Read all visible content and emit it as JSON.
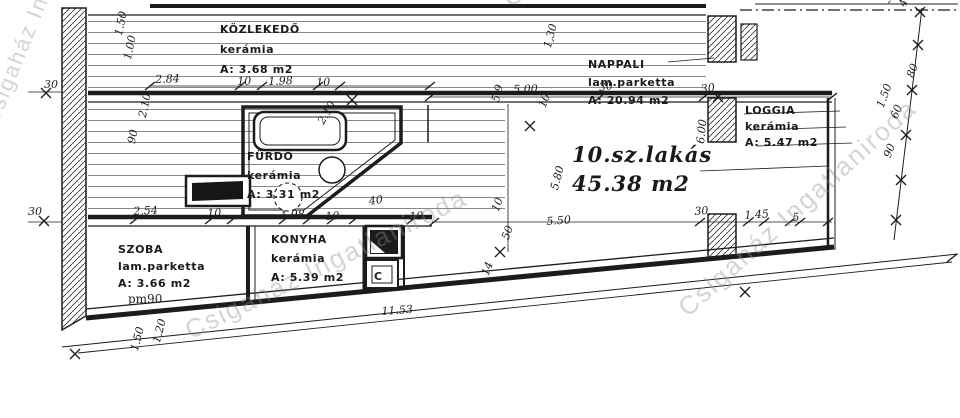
{
  "title": "10.sz.lakás floor plan",
  "colors": {
    "ink": "#1c1c1c",
    "paper": "#ffffff",
    "watermark_gray": "#8f8f8f"
  },
  "apartment": {
    "line1": "10.sz.lakás",
    "line2": "45.38 m2"
  },
  "watermark": {
    "text": "Csigaház Ingatlaniroda",
    "items": [
      {
        "x": 496,
        "y": -10,
        "r": -40,
        "s": 26
      },
      {
        "x": 180,
        "y": 318,
        "r": -26,
        "s": 26
      },
      {
        "x": 672,
        "y": 300,
        "r": -42,
        "s": 26
      },
      {
        "x": -22,
        "y": 120,
        "r": -68,
        "s": 22
      }
    ]
  },
  "rooms": [
    {
      "id": "kozlekedo",
      "x": 220,
      "y": 20,
      "lh": 20,
      "lines": [
        "KÖZLEKEDŐ",
        "kerámia",
        "A: 3.68 m2"
      ]
    },
    {
      "id": "nappali",
      "x": 588,
      "y": 56,
      "lh": 18,
      "lines": [
        "NAPPALI",
        "lam.parketta",
        "A: 20.94 m2"
      ]
    },
    {
      "id": "loggia",
      "x": 745,
      "y": 103,
      "lh": 16,
      "lines": [
        "LOGGIA",
        "kerámia",
        "A: 5.47 m2"
      ]
    },
    {
      "id": "furdo",
      "x": 247,
      "y": 147,
      "lh": 19,
      "lines": [
        "FÜRDŐ",
        "kerámia",
        "A: 3.31 m2"
      ]
    },
    {
      "id": "szoba",
      "x": 118,
      "y": 241,
      "lh": 17,
      "lines": [
        "SZOBA",
        "lam.parketta",
        "A: 3.66 m2"
      ]
    },
    {
      "id": "konyha",
      "x": 271,
      "y": 230,
      "lh": 19,
      "lines": [
        "KONYHA",
        "kerámia",
        "A: 5.39 m2"
      ]
    }
  ],
  "labels": [
    {
      "t": "pm90",
      "x": 128,
      "y": 292,
      "name": "parapet-height-label"
    },
    {
      "t": "C",
      "x": 374,
      "y": 270,
      "cls": "c-label",
      "name": "convector-label"
    }
  ],
  "dimensions": [
    {
      "t": "30",
      "x": 44,
      "y": 78,
      "r": 0
    },
    {
      "t": "30",
      "x": 28,
      "y": 205,
      "r": 0
    },
    {
      "t": "1.50",
      "x": 112,
      "y": 34,
      "r": -78
    },
    {
      "t": "1.00",
      "x": 121,
      "y": 58,
      "r": -78
    },
    {
      "t": "2.84",
      "x": 155,
      "y": 73,
      "r": -2
    },
    {
      "t": "10",
      "x": 237,
      "y": 75,
      "r": -2
    },
    {
      "t": "1.98",
      "x": 268,
      "y": 75,
      "r": -2
    },
    {
      "t": "10",
      "x": 316,
      "y": 76,
      "r": -2
    },
    {
      "t": "5,00",
      "x": 513,
      "y": 83,
      "r": -2
    },
    {
      "t": "1,30",
      "x": 541,
      "y": 46,
      "r": -75
    },
    {
      "t": "5.9",
      "x": 489,
      "y": 100,
      "r": -75
    },
    {
      "t": "10",
      "x": 536,
      "y": 105,
      "r": -70
    },
    {
      "t": "30",
      "x": 598,
      "y": 81,
      "r": -8
    },
    {
      "t": "30",
      "x": 700,
      "y": 83,
      "r": -8
    },
    {
      "t": "2.10",
      "x": 136,
      "y": 116,
      "r": -78
    },
    {
      "t": "90",
      "x": 125,
      "y": 142,
      "r": -78
    },
    {
      "t": "2.10",
      "x": 315,
      "y": 120,
      "r": -60
    },
    {
      "t": "6.00",
      "x": 694,
      "y": 143,
      "r": -84
    },
    {
      "t": "2.54",
      "x": 133,
      "y": 205,
      "r": -3
    },
    {
      "t": "10",
      "x": 207,
      "y": 207,
      "r": -3
    },
    {
      "t": "1.98",
      "x": 280,
      "y": 209,
      "r": -3
    },
    {
      "t": "10",
      "x": 325,
      "y": 210,
      "r": -3
    },
    {
      "t": "40",
      "x": 368,
      "y": 195,
      "r": -8
    },
    {
      "t": "10",
      "x": 409,
      "y": 210,
      "r": -3
    },
    {
      "t": "5.80",
      "x": 548,
      "y": 188,
      "r": -75
    },
    {
      "t": "5.50",
      "x": 546,
      "y": 215,
      "r": -4
    },
    {
      "t": "30",
      "x": 694,
      "y": 205,
      "r": -4
    },
    {
      "t": "1.45",
      "x": 744,
      "y": 209,
      "r": -4
    },
    {
      "t": "5",
      "x": 792,
      "y": 211,
      "r": -4
    },
    {
      "t": "10",
      "x": 489,
      "y": 209,
      "r": -70
    },
    {
      "t": "50",
      "x": 499,
      "y": 237,
      "r": -70
    },
    {
      "t": "14",
      "x": 479,
      "y": 273,
      "r": -70
    },
    {
      "t": "11.53",
      "x": 381,
      "y": 305,
      "r": -4
    },
    {
      "t": "1.20",
      "x": 150,
      "y": 341,
      "r": -75
    },
    {
      "t": "1.50",
      "x": 128,
      "y": 349,
      "r": -75
    },
    {
      "t": "30",
      "x": 880,
      "y": 0,
      "r": -70
    },
    {
      "t": "40",
      "x": 896,
      "y": 4,
      "r": -70
    },
    {
      "t": "80",
      "x": 904,
      "y": 75,
      "r": -70
    },
    {
      "t": "1.50",
      "x": 874,
      "y": 105,
      "r": -70
    },
    {
      "t": "60",
      "x": 888,
      "y": 116,
      "r": -70
    },
    {
      "t": "90",
      "x": 881,
      "y": 155,
      "r": -70
    }
  ]
}
